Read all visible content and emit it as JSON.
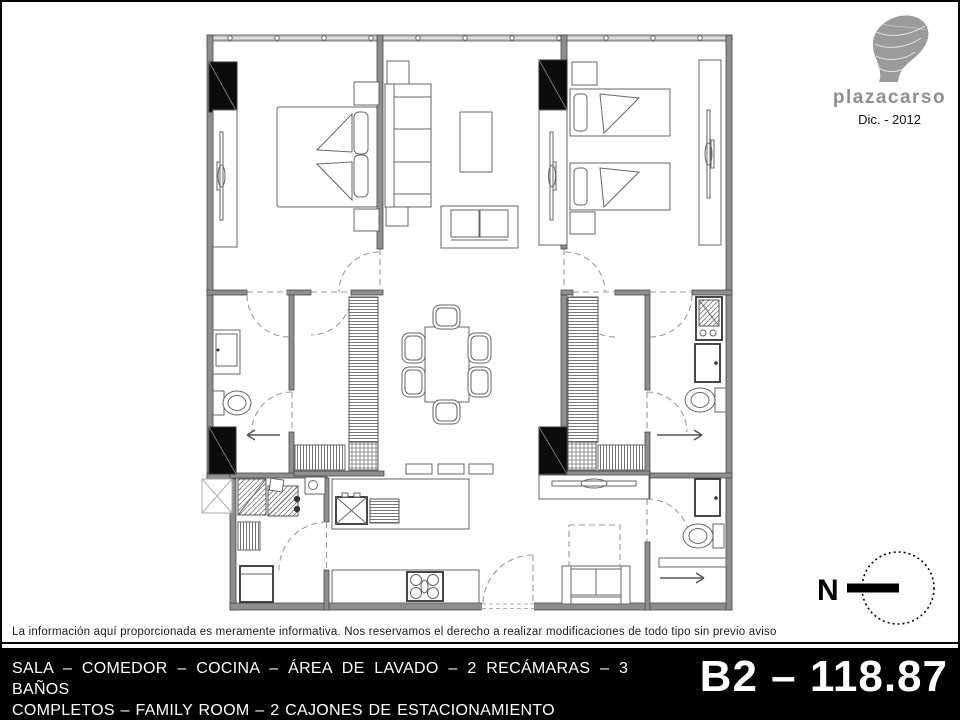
{
  "page": {
    "background": "#ffffff",
    "border_color": "#000000"
  },
  "logo": {
    "brand": "plazacarso",
    "date": "Dic. - 2012",
    "brand_color": "#8f8f8f",
    "icon": "soumaya-building-icon"
  },
  "north": {
    "label": "N"
  },
  "disclaimer": {
    "text": "La información aquí proporcionada es meramente informativa. Nos reservamos el derecho a realizar modificaciones de todo tipo sin previo aviso"
  },
  "footer": {
    "background": "#000000",
    "text_color": "#ffffff",
    "description_line1": "SALA – COMEDOR – COCINA – ÁREA DE LAVADO – 2 RECÁMARAS – 3 BAÑOS",
    "description_line2": "COMPLETOS – FAMILY ROOM – 2 CAJONES DE ESTACIONAMIENTO",
    "unit_label": "B2 – 118.87"
  }
}
